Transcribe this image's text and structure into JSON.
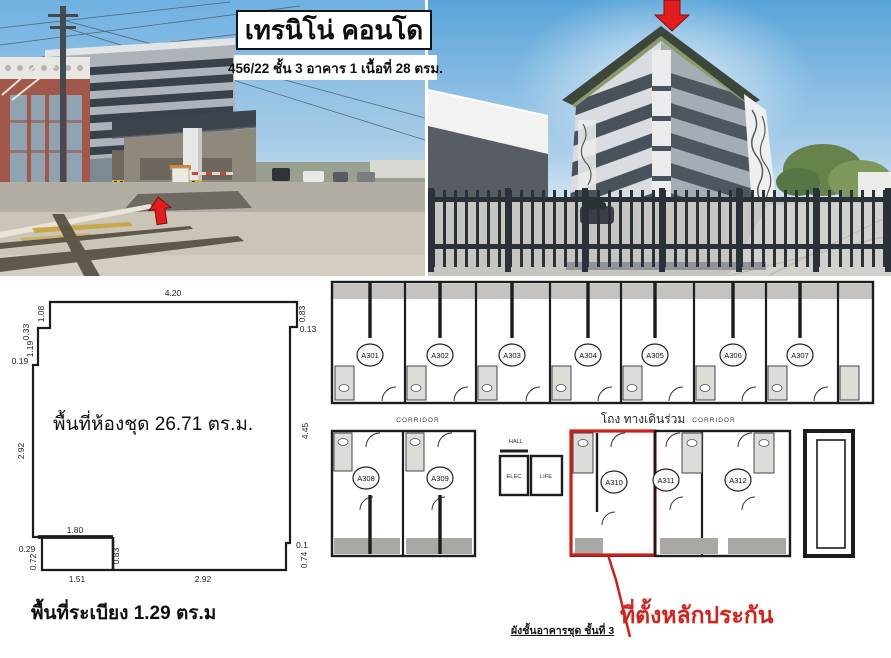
{
  "header": {
    "title": "เทรนิโน่ คอนโด",
    "subtitle": "456/22 ชั้น 3 อาคาร 1 เนื้อที่ 28 ตรม."
  },
  "unit_plan": {
    "room_area_label": "พื้นที่ห้องชุด 26.71 ตร.ม.",
    "balcony_area_label": "พื้นที่ระเบียง 1.29 ตร.ม",
    "dims": {
      "top": "4.20",
      "left_1": "1.08",
      "left_2": "0.33",
      "left_3": "1.19",
      "left_4": "0.19",
      "left_5": "2.92",
      "right_1": "0.83",
      "right_2": "0.13",
      "right_3": "4.45",
      "right_4": "0.1",
      "right_5": "0.74",
      "balcony_top": "1.80",
      "balcony_left_offset": "0.29",
      "balcony_left": "0.72",
      "balcony_right": "0.83",
      "bottom_left": "1.51",
      "bottom_right": "2.92"
    }
  },
  "floor_plan": {
    "top_rooms": [
      "A301",
      "A302",
      "A303",
      "A304",
      "A305",
      "A306",
      "A307"
    ],
    "bottom_left_rooms": [
      "A308",
      "A309"
    ],
    "highlighted_room": "A310",
    "bottom_right_rooms": [
      "A311",
      "A312"
    ],
    "corridor_left": "CORRIDOR",
    "corridor_right": "CORRIDOR",
    "corridor_thai": "โถง ทางเดินร่วม",
    "hall": "HALL",
    "elec": "ELEC",
    "lift": "LIFE",
    "annotation": "ที่ตั้งหลักประกัน",
    "caption": "ผังชั้นอาคารชุด ชั้นที่ 3"
  },
  "colors": {
    "highlight_red": "#cf1f1c",
    "arrow_red": "#e31d1d",
    "plan_line": "#1c1c1c"
  }
}
